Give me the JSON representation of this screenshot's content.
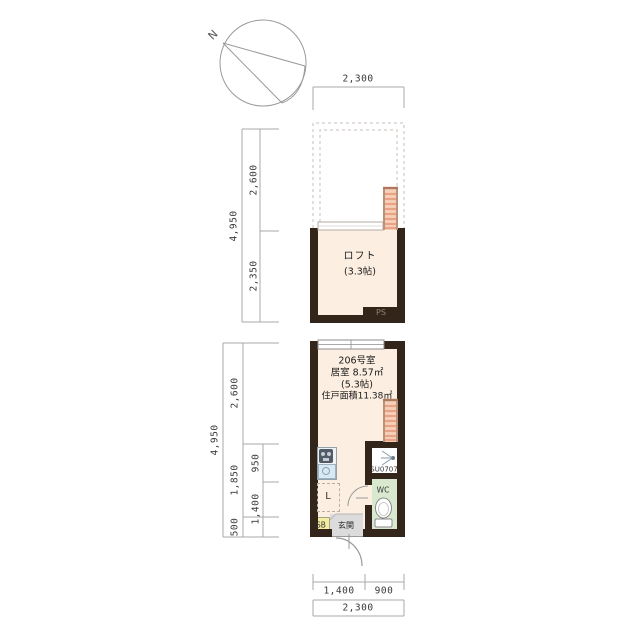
{
  "compass": {
    "north_label": "N"
  },
  "upper_plan": {
    "dims": {
      "width": "2,300",
      "total": "4,950",
      "void_depth": "2,600",
      "loft_depth": "2,350"
    },
    "loft_label": "ロフト",
    "loft_size": "(3.3帖)",
    "ps_label": "PS"
  },
  "lower_plan": {
    "unit_label": "206号室",
    "room_area": "居室 8.57㎡",
    "room_size": "(5.3帖)",
    "total_area": "住戸面積11.38㎡",
    "labels": {
      "shower": "SU0707",
      "wc": "WC",
      "laundry": "L",
      "shoebox": "SB",
      "entrance": "玄関"
    },
    "dims": {
      "total": "4,950",
      "room": "2,600",
      "mid": "1,850",
      "entry": "500",
      "sub_upper": "950",
      "sub_lower": "1,400",
      "bottom_left": "1,400",
      "bottom_right": "900",
      "bottom_total": "2,300"
    }
  },
  "colors": {
    "wall": "#33251a",
    "floor": "#fcefe1",
    "wc_floor": "#d9e9d0",
    "entrance_floor": "#dcdcdc",
    "shoebox": "#f2ee9f",
    "ladder": "#f7d0b9",
    "ladder_rung": "#e9a284",
    "kitchen_counter": "#eef2f5",
    "sink": "#d8e9f3"
  }
}
